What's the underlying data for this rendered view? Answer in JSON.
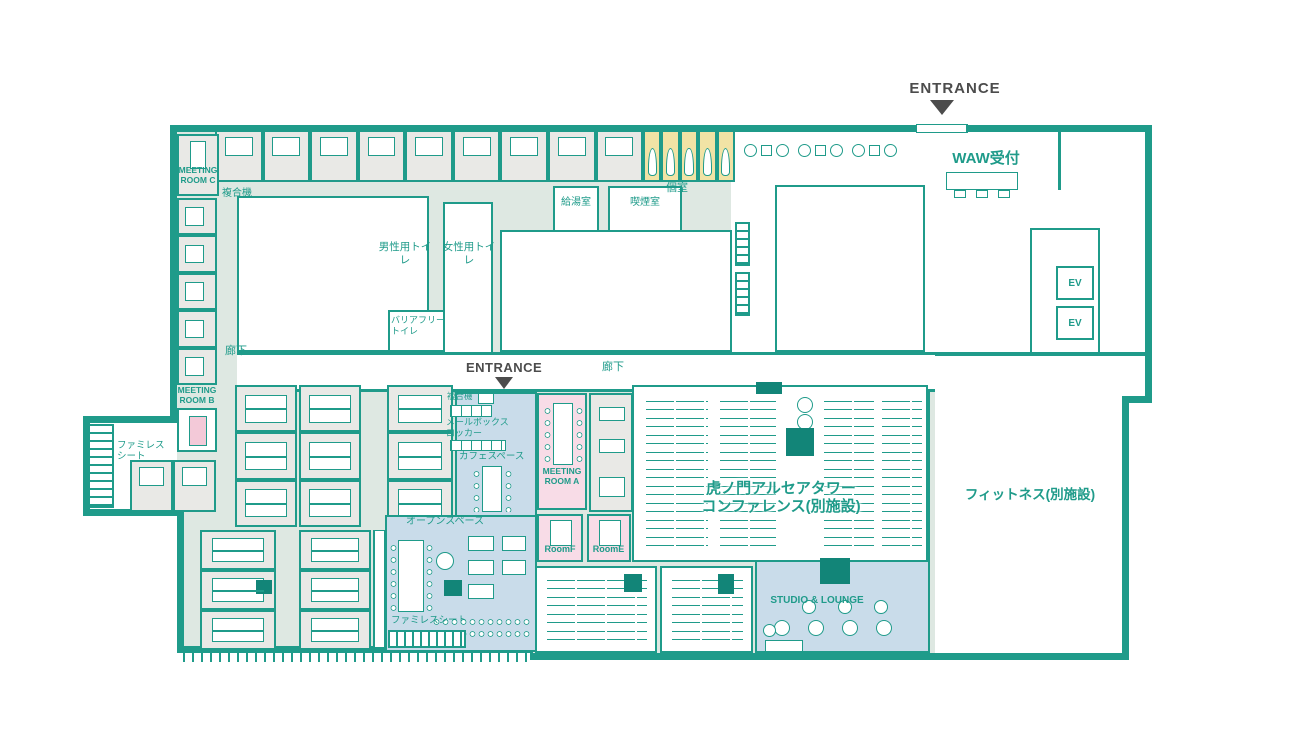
{
  "title": "WAW 虎ノ門 フロアマップ",
  "colors": {
    "wall_teal": "#1F9B8A",
    "corridor_mint": "#DEE8E2",
    "office_gray": "#E9E9E6",
    "zone_blue": "#C9DCEA",
    "room_pink": "#F8DCE7",
    "booth_yellow": "#F1E3A5",
    "pillar_dark": "#128578",
    "entrance_ink": "#4C4C4C"
  },
  "labels": {
    "entrance_top": "ENTRANCE",
    "entrance_center": "ENTRANCE",
    "reception": "WAW受付",
    "meeting_room_c": "MEETING\nROOM C",
    "meeting_room_b": "MEETING\nROOM B",
    "meeting_room_a": "MEETING\nROOM A",
    "copier_top": "複合機",
    "copier_center": "複合機",
    "private_booth": "個室",
    "kitchenette": "給湯室",
    "smoking_room": "喫煙室",
    "mens_toilet": "男性用トイレ",
    "womens_toilet": "女性用トイレ",
    "accessible_toilet": "バリアフリー\nトイレ",
    "corridor_left": "廊下",
    "corridor_center": "廊下",
    "famiresu_left": "ファミレス\nシート",
    "famiresu_bottom": "ファミレスシート",
    "mailbox_locker": "メールボックス\nロッカー",
    "cafe_space": "カフェスペース",
    "open_space": "オープンスペース",
    "room_f": "RoomF",
    "room_e": "RoomE",
    "conference": "虎ノ門アルセアタワー\nコンファレンス(別施設)",
    "fitness": "フィットネス(別施設)",
    "studio_lounge": "STUDIO & LOUNGE",
    "elevator_1": "EV",
    "elevator_2": "EV"
  }
}
